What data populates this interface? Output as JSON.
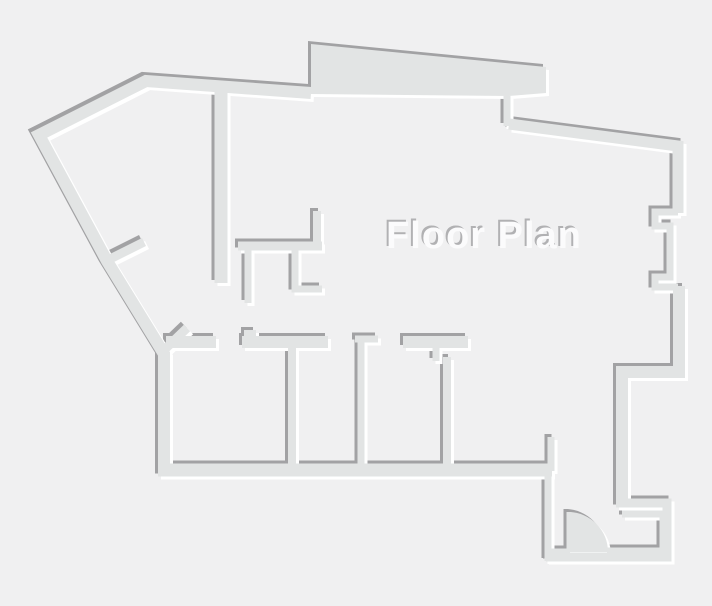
{
  "title": {
    "label": "Floor Plan"
  },
  "canvas": {
    "width": 712,
    "height": 606
  },
  "colors": {
    "background": "#f0f0f1",
    "wall": "#e2e4e4",
    "shadow": "#a2a2a4",
    "highlight": "#ffffff",
    "text": "#fbfbfc",
    "text_shadow": "#b1b1b3"
  },
  "emboss": {
    "wall_offset": 3,
    "text_offset": 2
  },
  "label": {
    "x": 484,
    "y": 248,
    "font_size": 38
  },
  "plan": {
    "wall_lines": [
      {
        "name": "outer-left-boundary",
        "w": 12,
        "points": [
          [
            311,
            93
          ],
          [
            146,
            81
          ],
          [
            39,
            135
          ],
          [
            107,
            261
          ],
          [
            164,
            354
          ],
          [
            164,
            471
          ]
        ]
      },
      {
        "name": "top-band-jamb",
        "w": 7,
        "points": [
          [
            507,
            96
          ],
          [
            507,
            126
          ]
        ]
      },
      {
        "name": "outer-top-right",
        "w": 11,
        "points": [
          [
            509,
            124
          ],
          [
            678,
            146
          ],
          [
            678,
            213
          ]
        ]
      },
      {
        "name": "right-wall-recess",
        "w": 7,
        "points": [
          [
            678,
            212
          ],
          [
            655,
            212
          ],
          [
            655,
            226
          ],
          [
            670,
            226
          ],
          [
            670,
            277
          ],
          [
            655,
            277
          ],
          [
            655,
            287
          ],
          [
            678,
            287
          ]
        ]
      },
      {
        "name": "outer-right-lower",
        "w": 12,
        "points": [
          [
            679,
            286
          ],
          [
            679,
            372
          ],
          [
            622,
            372
          ],
          [
            622,
            505
          ]
        ]
      },
      {
        "name": "entry-outer-hook",
        "w": 9,
        "points": [
          [
            616,
            503
          ],
          [
            667,
            503
          ],
          [
            667,
            557
          ],
          [
            546,
            557
          ]
        ]
      },
      {
        "name": "entry-left-wall-lower",
        "w": 7,
        "points": [
          [
            548,
            561
          ],
          [
            548,
            470
          ]
        ]
      },
      {
        "name": "entry-left-wall-upper",
        "w": 7,
        "points": [
          [
            551,
            471
          ],
          [
            551,
            437
          ]
        ]
      },
      {
        "name": "bottom-wall",
        "w": 13,
        "points": [
          [
            158,
            470
          ],
          [
            552,
            470
          ]
        ]
      },
      {
        "name": "entry-inner-hook",
        "w": 7,
        "points": [
          [
            622,
            514
          ],
          [
            663,
            514
          ],
          [
            663,
            551
          ],
          [
            607,
            551
          ]
        ]
      },
      {
        "name": "door-sill-stub",
        "w": 7,
        "points": [
          [
            548,
            552
          ],
          [
            570,
            552
          ]
        ]
      },
      {
        "name": "door-leaf",
        "w": 5,
        "points": [
          [
            569,
            551
          ],
          [
            569,
            512
          ]
        ]
      },
      {
        "name": "interior-vertical-long",
        "w": 13,
        "points": [
          [
            221,
            87
          ],
          [
            221,
            283
          ]
        ]
      },
      {
        "name": "closet-horizontal",
        "w": 9,
        "points": [
          [
            238,
            246
          ],
          [
            322,
            246
          ]
        ]
      },
      {
        "name": "closet-stub-up",
        "w": 8,
        "points": [
          [
            317,
            211
          ],
          [
            317,
            242
          ]
        ]
      },
      {
        "name": "closet-stub-down-1",
        "w": 7,
        "points": [
          [
            248,
            250
          ],
          [
            248,
            303
          ]
        ]
      },
      {
        "name": "closet-stub-down-2",
        "w": 7,
        "points": [
          [
            295,
            250
          ],
          [
            295,
            289
          ],
          [
            322,
            289
          ]
        ]
      },
      {
        "name": "left-spur-a",
        "w": 9,
        "points": [
          [
            104,
            262
          ],
          [
            144,
            242
          ]
        ]
      },
      {
        "name": "left-spur-b",
        "w": 9,
        "points": [
          [
            161,
            353
          ],
          [
            187,
            328
          ]
        ]
      },
      {
        "name": "hall-wall-segment-1",
        "w": 12,
        "points": [
          [
            166,
            342
          ],
          [
            216,
            342
          ]
        ]
      },
      {
        "name": "hall-wall-segment-2",
        "w": 12,
        "points": [
          [
            242,
            342
          ],
          [
            328,
            342
          ]
        ]
      },
      {
        "name": "hall-wall-segment-2-bump",
        "w": 12,
        "points": [
          [
            244,
            336
          ],
          [
            256,
            336
          ]
        ]
      },
      {
        "name": "hall-wall-cap-3",
        "w": 7,
        "points": [
          [
            355,
            339
          ],
          [
            378,
            339
          ]
        ]
      },
      {
        "name": "room-divider-2",
        "w": 7,
        "points": [
          [
            361,
            339
          ],
          [
            361,
            465
          ]
        ]
      },
      {
        "name": "hall-wall-segment-4",
        "w": 12,
        "points": [
          [
            403,
            342
          ],
          [
            468,
            342
          ]
        ]
      },
      {
        "name": "hall-wall-segment-4-stub",
        "w": 7,
        "points": [
          [
            436,
            347
          ],
          [
            436,
            361
          ]
        ]
      },
      {
        "name": "room-divider-3",
        "w": 8,
        "points": [
          [
            447,
            357
          ],
          [
            447,
            465
          ]
        ]
      },
      {
        "name": "room-divider-1",
        "w": 8,
        "points": [
          [
            292,
            344
          ],
          [
            292,
            465
          ]
        ]
      }
    ],
    "wall_polygons": [
      {
        "name": "top-thick-band",
        "points": [
          [
            311,
            44
          ],
          [
            546,
            67
          ],
          [
            546,
            93
          ],
          [
            509,
            96
          ],
          [
            311,
            94
          ]
        ]
      }
    ],
    "door": {
      "swing_path": "M 569 512 A 40 40 0 0 1 608 552 L 569 552 Z"
    }
  }
}
